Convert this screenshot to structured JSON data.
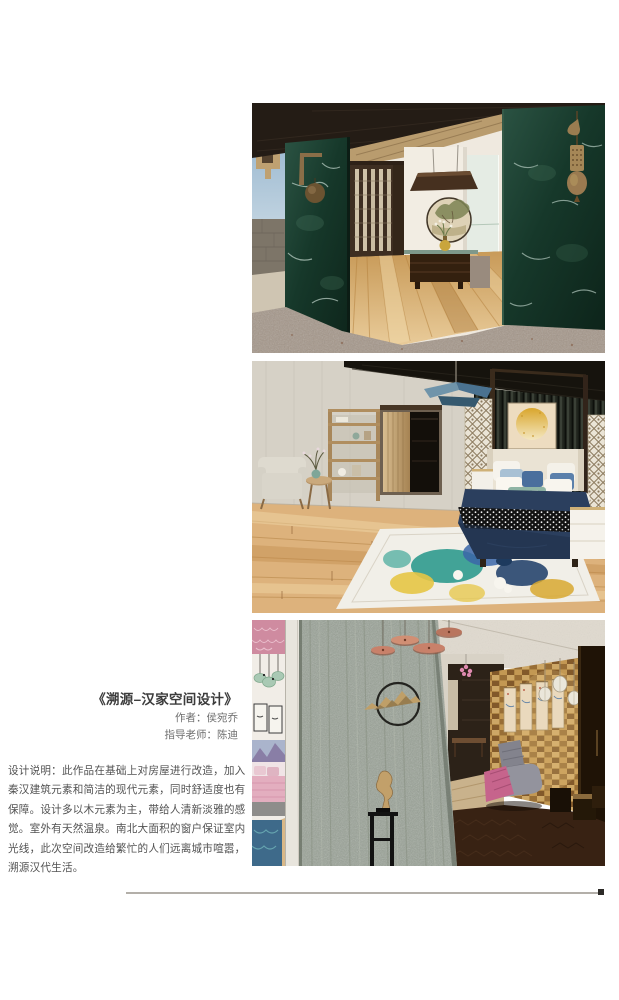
{
  "artwork": {
    "title": "《溯源–汉家空间设计》",
    "author": "作者：侯宛乔",
    "advisor": "指导老师：陈迪",
    "description_lines": [
      "设计说明：此作品在基础上对房屋进行改造，加入",
      "秦汉建筑元素和简洁的现代元素，同时舒适度也有",
      "保障。设计多以木元素为主，带给人清新淡雅的感",
      "觉。室外有天然温泉。南北大面积的窗户保证室内",
      "光线，此次空间改造给繁忙的人们远离城市喧嚣，",
      "溯源汉代生活。"
    ]
  },
  "figures": [
    {
      "label": "entrance-hall-render"
    },
    {
      "label": "bedroom-render"
    },
    {
      "label": "lounge-render"
    }
  ],
  "palette": {
    "marble_green": "#1e4636",
    "wood_floor": "#d9a96e",
    "granite": "#a3958a",
    "navy_bedding": "#2b3f5e",
    "rug_teal": "#2f9a8e",
    "rug_yellow": "#e6c545",
    "stone_wall": "#98a296",
    "gold_wall": "#c59a5c",
    "copper_lamp": "#c8816a",
    "pink_bed": "#e3aebf",
    "divider": "#b3afa9"
  }
}
